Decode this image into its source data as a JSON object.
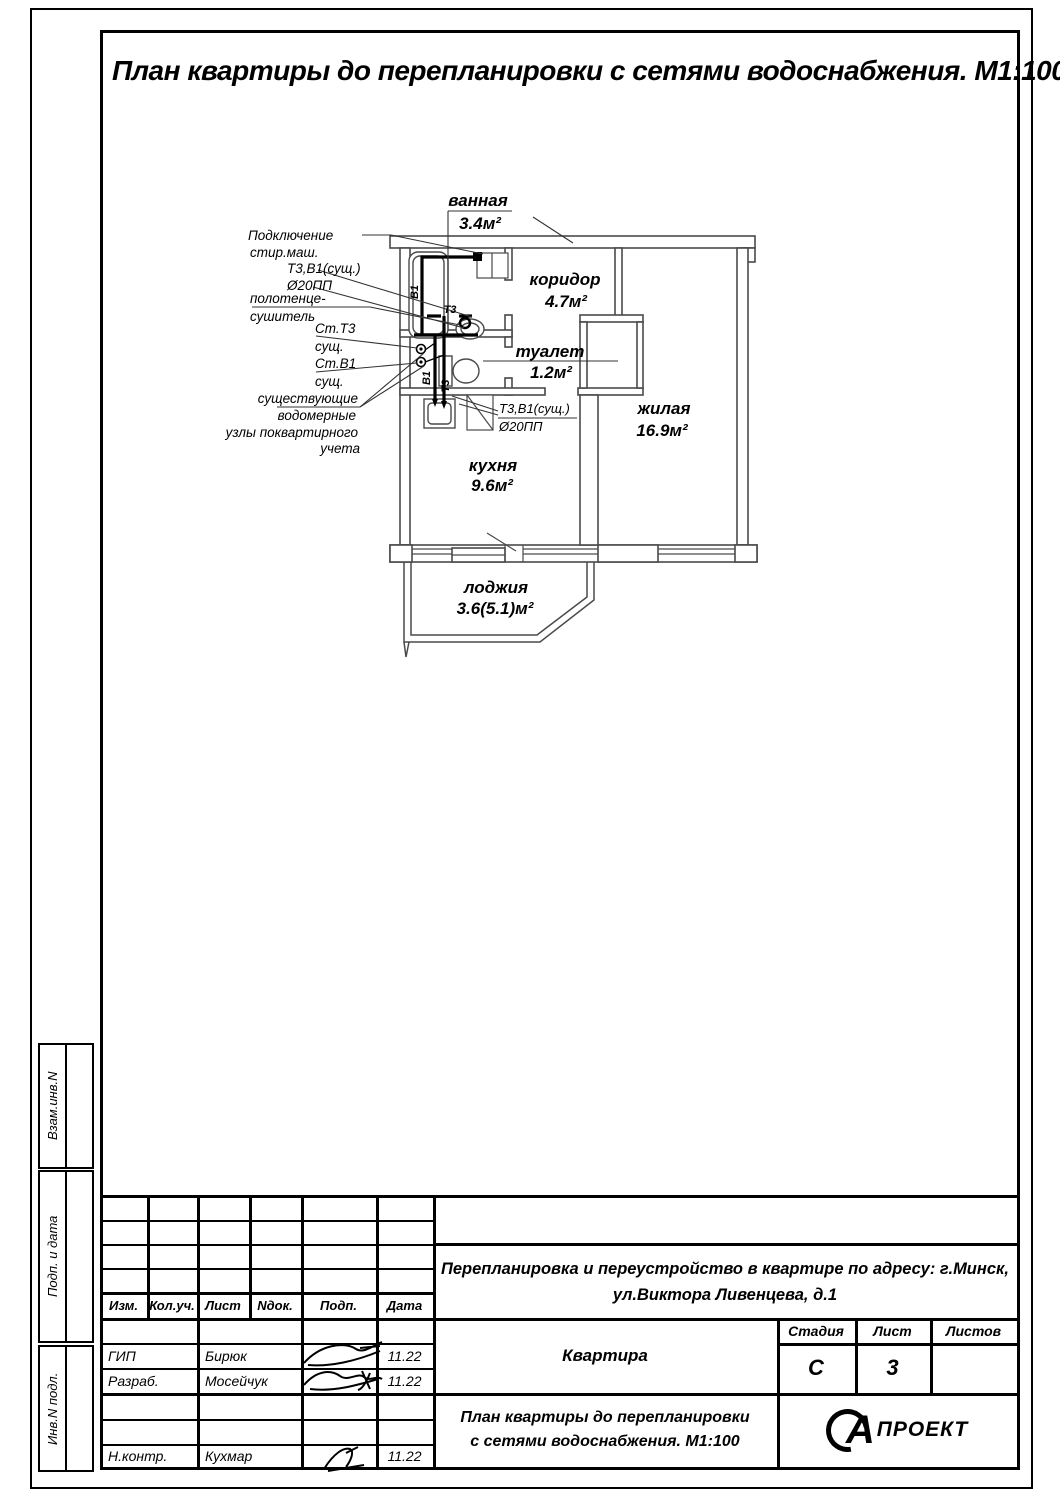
{
  "page": {
    "title": "План квартиры до перепланировки с сетями водоснабжения. М1:100"
  },
  "plan": {
    "rooms": {
      "bath": {
        "name": "ванная",
        "area": "3.4м²"
      },
      "corridor": {
        "name": "коридор",
        "area": "4.7м²"
      },
      "wc": {
        "name": "туалет",
        "area": "1.2м²"
      },
      "living": {
        "name": "жилая",
        "area": "16.9м²"
      },
      "kitchen": {
        "name": "кухня",
        "area": "9.6м²"
      },
      "loggia": {
        "name": "лоджия",
        "area": "3.6(5.1)м²"
      }
    },
    "pipe_labels": {
      "v1": "В1",
      "t3": "Т3"
    },
    "kitchen_note": {
      "line1": "Т3,В1(сущ.)",
      "line2": "Ø20ПП"
    },
    "annotations": {
      "washer": [
        "Подключение",
        "стир.маш."
      ],
      "pipes": [
        "Т3,В1(сущ.)",
        "Ø20ПП"
      ],
      "towel": [
        "полотенце-",
        "сушитель"
      ],
      "riser_t3": [
        "Ст.Т3",
        "сущ."
      ],
      "riser_v1": [
        "Ст.В1",
        "сущ."
      ],
      "meters": [
        "существующие",
        "водомерные",
        "узлы поквартирного",
        "учета"
      ]
    }
  },
  "margins": {
    "labels": [
      "Взам.инв.N",
      "Подп. и дата",
      "Инв.N подл."
    ]
  },
  "titleblock": {
    "cols": [
      "Изм.",
      "Кол.уч.",
      "Лист",
      "Nдок.",
      "Подп.",
      "Дата"
    ],
    "project_line1": "Перепланировка и переустройство в квартире по адресу: г.Минск,",
    "project_line2": "ул.Виктора Ливенцева, д.1",
    "object_name": "Квартира",
    "stage_label": "Стадия",
    "sheet_label": "Лист",
    "sheets_label": "Листов",
    "stage": "С",
    "sheet": "3",
    "sheets": "",
    "doc_line1": "План квартиры до перепланировки",
    "doc_line2": "с сетями водоснабжения. М1:100",
    "rows": [
      {
        "role": "ГИП",
        "name": "Бирюк",
        "date": "11.22"
      },
      {
        "role": "Разраб.",
        "name": "Мосейчук",
        "date": "11.22"
      },
      {
        "role": "Н.контр.",
        "name": "Кухмар",
        "date": "11.22"
      }
    ],
    "logo_a": "А",
    "logo_text": "ПРОЕКТ"
  }
}
